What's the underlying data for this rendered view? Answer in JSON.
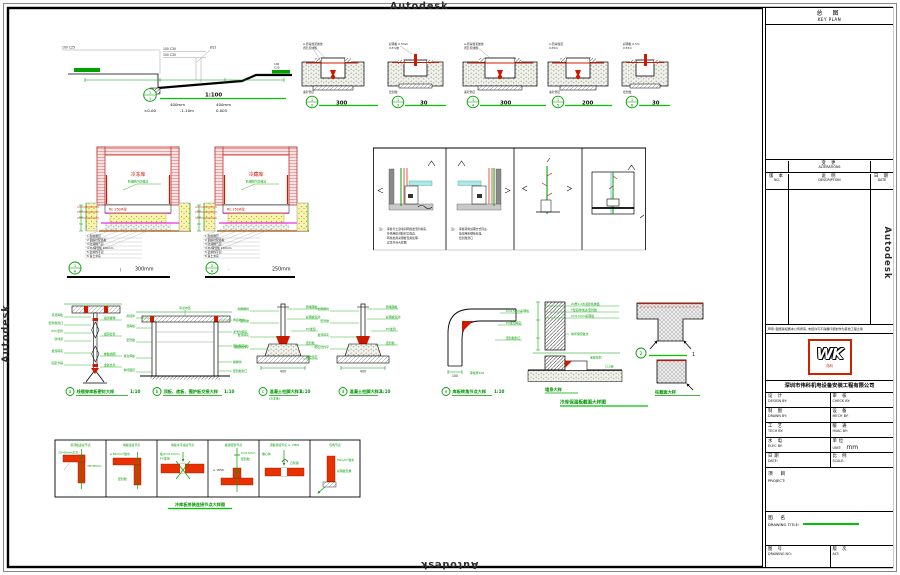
{
  "watermarks": {
    "top": "Autodesk",
    "bottom": "Autodesk",
    "left": "Autodesk",
    "right": "Autodesk"
  },
  "ramp": {
    "c25": "100  C25",
    "c30a": "100  C30",
    "c30b": "100  C30",
    "d12": "Ø12",
    "bt": "1",
    "bb": "1",
    "scale": "1:100",
    "dim1": "400mm",
    "dim2": "400mm",
    "lv1": "±0.00",
    "lv2": "-1.10m",
    "lv3": "0.005",
    "rt1": "100",
    "rt2": "C20"
  },
  "trenches": {
    "items": [
      {
        "top": "1",
        "bot": "2",
        "scale": "300",
        "l1": "A-沥青胶泥嵌缝",
        "l2": "闭孔泡沫板",
        "l3": "素砼垫层"
      },
      {
        "top": "1",
        "bot": "3",
        "scale": "30",
        "l1": "彩钢板 0.5mm",
        "l2": "0.5%坡",
        "l3": "密封胶"
      },
      {
        "top": "1",
        "bot": "4",
        "scale": "300",
        "l1": "A-沥青胶泥嵌缝",
        "l2": "闭孔泡沫板",
        "l3": "素砼垫层"
      },
      {
        "top": "1",
        "bot": "5",
        "scale": "200",
        "l1": "A-沥青胶泥",
        "l2": "0.55m",
        "l3": "素砼垫层"
      },
      {
        "top": "1",
        "bot": "6",
        "scale": "30",
        "l1": "彩钢板 0.5m",
        "l2": "0.55m",
        "l3": "密封胶"
      }
    ]
  },
  "tanks": {
    "items": [
      {
        "bt": "1",
        "bb": "A",
        "name": "冷冻库",
        "leader": "防潮隔汽层做法",
        "slab": "RC 250#砼",
        "sep": "|",
        "dim": "300mm",
        "n1": "1 耐磨面层",
        "n2": "2 钢筋砼配筋板",
        "n3": "3 防潮隔汽层",
        "n4": "4 PU保温板 200mm",
        "n5": "5 砂浆找平层",
        "n6": "6 素土夯实"
      },
      {
        "bt": "2",
        "bb": "A",
        "name": "冷藏库",
        "leader": "防潮隔汽层做法",
        "slab": "RC 250#砼",
        "sep": "-",
        "dim": "250mm",
        "n1": "1 耐磨面层",
        "n2": "2 钢筋砼配筋板",
        "n3": "3 防潮隔汽层",
        "n4": "4 PU保温板 150mm",
        "n5": "5 砂浆找平层",
        "n6": "6 素土夯实"
      }
    ]
  },
  "panels": {
    "note_label": "注:",
    "a1": "库板与土建墙间隙用发泡剂填实,",
    "a2": "外侧用密封胶封口收边,",
    "a3": "转角处用彩钢板包角处理,",
    "a4": "详见节点大样图",
    "b1": "库板转角处理方式同左,",
    "b2": "角部用彩钢板包角,",
    "b3": "密封胶封口"
  },
  "details": {
    "items": [
      {
        "letter": "a",
        "caption": "线缆穿库板密封大样",
        "scale": "1:10"
      },
      {
        "letter": "b",
        "caption": "顶板、底板、围护板交接大样",
        "scale": "1:10"
      },
      {
        "letter": "c",
        "caption": "混凝土柱脚大样1",
        "scale": "1:10",
        "sub": "(冷冻库)"
      },
      {
        "letter": "d",
        "caption": "混凝土柱脚大样2",
        "scale": "1:10"
      },
      {
        "letter": "e",
        "caption": "库板转角节点大样",
        "scale": "1:10"
      }
    ],
    "a": {
      "left": [
        "吊顶库板",
        "密封胶封口",
        "PVC套管",
        "穿线束",
        "发泡填实",
        "固定卡箍"
      ],
      "right": [
        "锁紧螺母",
        "镀锌套管",
        "橡胶挡圈",
        "金属支架"
      ]
    },
    "b": {
      "top": "吊点布置",
      "left": [
        "吊挂件",
        "顶库板",
        "密封胶",
        "墙身库板",
        "地坪面层"
      ],
      "right": [
        "角铝收边",
        "发泡剂填实",
        "聚氨酯芯材",
        "踢脚线",
        "密封胶封口"
      ]
    },
    "c": {
      "left": [
        "地脚螺栓",
        "密封胶",
        "发泡填实",
        "细石砼找平"
      ],
      "right": [
        "预埋钢板",
        "彩钢板包边",
        "PU发泡",
        "密封胶",
        "素砼垫层"
      ],
      "dim": "400"
    },
    "d": {
      "left": [
        "地脚螺栓",
        "密封胶",
        "发泡填实",
        "细石砼找平"
      ],
      "right": [
        "预埋钢板",
        "彩钢板包边",
        "PU发泡",
        "密封胶"
      ],
      "dim": "400"
    },
    "e": {
      "right": [
        "δ=0.5mm彩钢板",
        "PU发泡填实",
        "密封胶封口"
      ],
      "bottom": "库板厚100",
      "dim": "100"
    }
  },
  "wallsec": {
    "t1": "20厚1:2水泥砂浆抹面",
    "t2": "T型铝材收边/密封胶",
    "t3": "δ=0.5mm彩钢板",
    "t4": "地坪保温做法",
    "t5": "素砼垫层",
    "t6": "C15砼",
    "cap_left": "墙身大样",
    "cap_right": "柱截面大样",
    "cap_center": "冷库保温板截面大样图",
    "marker": "2",
    "mside": "1"
  },
  "btable": {
    "caption": "冷库板拼装连接节点大样图",
    "cols": [
      {
        "h": "吊顶板连接节点",
        "t1": "30*40mm木方",
        "t2": "38*38mm"
      },
      {
        "h": "墙板连接节点",
        "t1": "ø 50m/m²胶水",
        "t2": "密封胶"
      },
      {
        "h": "墙板水平连接节点",
        "t1": "板(δ=0.5mm)",
        "t2": "PU发泡"
      },
      {
        "h": "板缝密封节点",
        "t1": "δ=0.5mm",
        "t2": "密封胶",
        "t3": "A. VIEW"
      },
      {
        "h": "顶板吊挂节点 A. VIEW",
        "t1": "偏心钩",
        "t2": "凸轮锁"
      },
      {
        "h": "包角节点",
        "t1": "50m/m²胶水",
        "t2": "彩钢板包角"
      }
    ]
  },
  "titleblock": {
    "keyplan_cn": "总    图",
    "keyplan_en": "KEY PLAN",
    "alt_cn": "变    更",
    "alt_en": "ALTERATIONS",
    "no_cn": "版 本",
    "no_en": "NO.",
    "desc_cn": "说    明",
    "desc_en": "DESCRIPTION",
    "date_cn": "日  期",
    "date_en": "DATE",
    "notice": "声明: 图纸版权属本公司所有, 未经许可不得翻印复制作为其他工程之用",
    "logo": "WK",
    "logo_sub": "伟科",
    "company": "深圳市伟科机电设备安装工程有限公司",
    "rows": [
      {
        "lc": "设    计",
        "le": "DESIGN BY:",
        "rc": "审    核",
        "re": "CHECK BY:"
      },
      {
        "lc": "制    图",
        "le": "DRAWN BY:",
        "rc": "设    备",
        "re": "MECH BY:"
      },
      {
        "lc": "工    艺",
        "le": "TECH BY:",
        "rc": "暖    通",
        "re": "HVAC BY:"
      },
      {
        "lc": "水    电",
        "le": "ELEC BY:",
        "rc": "单位",
        "re": "UNIT:",
        "rv": "mm"
      },
      {
        "lc": "日期",
        "le": "DATE:",
        "rc": "比 例",
        "re": "SCALE:"
      }
    ],
    "project_cn": "项    目",
    "project_en": "PROJECT:",
    "title_cn": "图    名",
    "title_en": "DRAWING TITLE:",
    "no2_cn": "图    号",
    "no2_en": "DRAWING NO:",
    "alt2_cn": "版 次",
    "alt2_en": "ALT:"
  }
}
